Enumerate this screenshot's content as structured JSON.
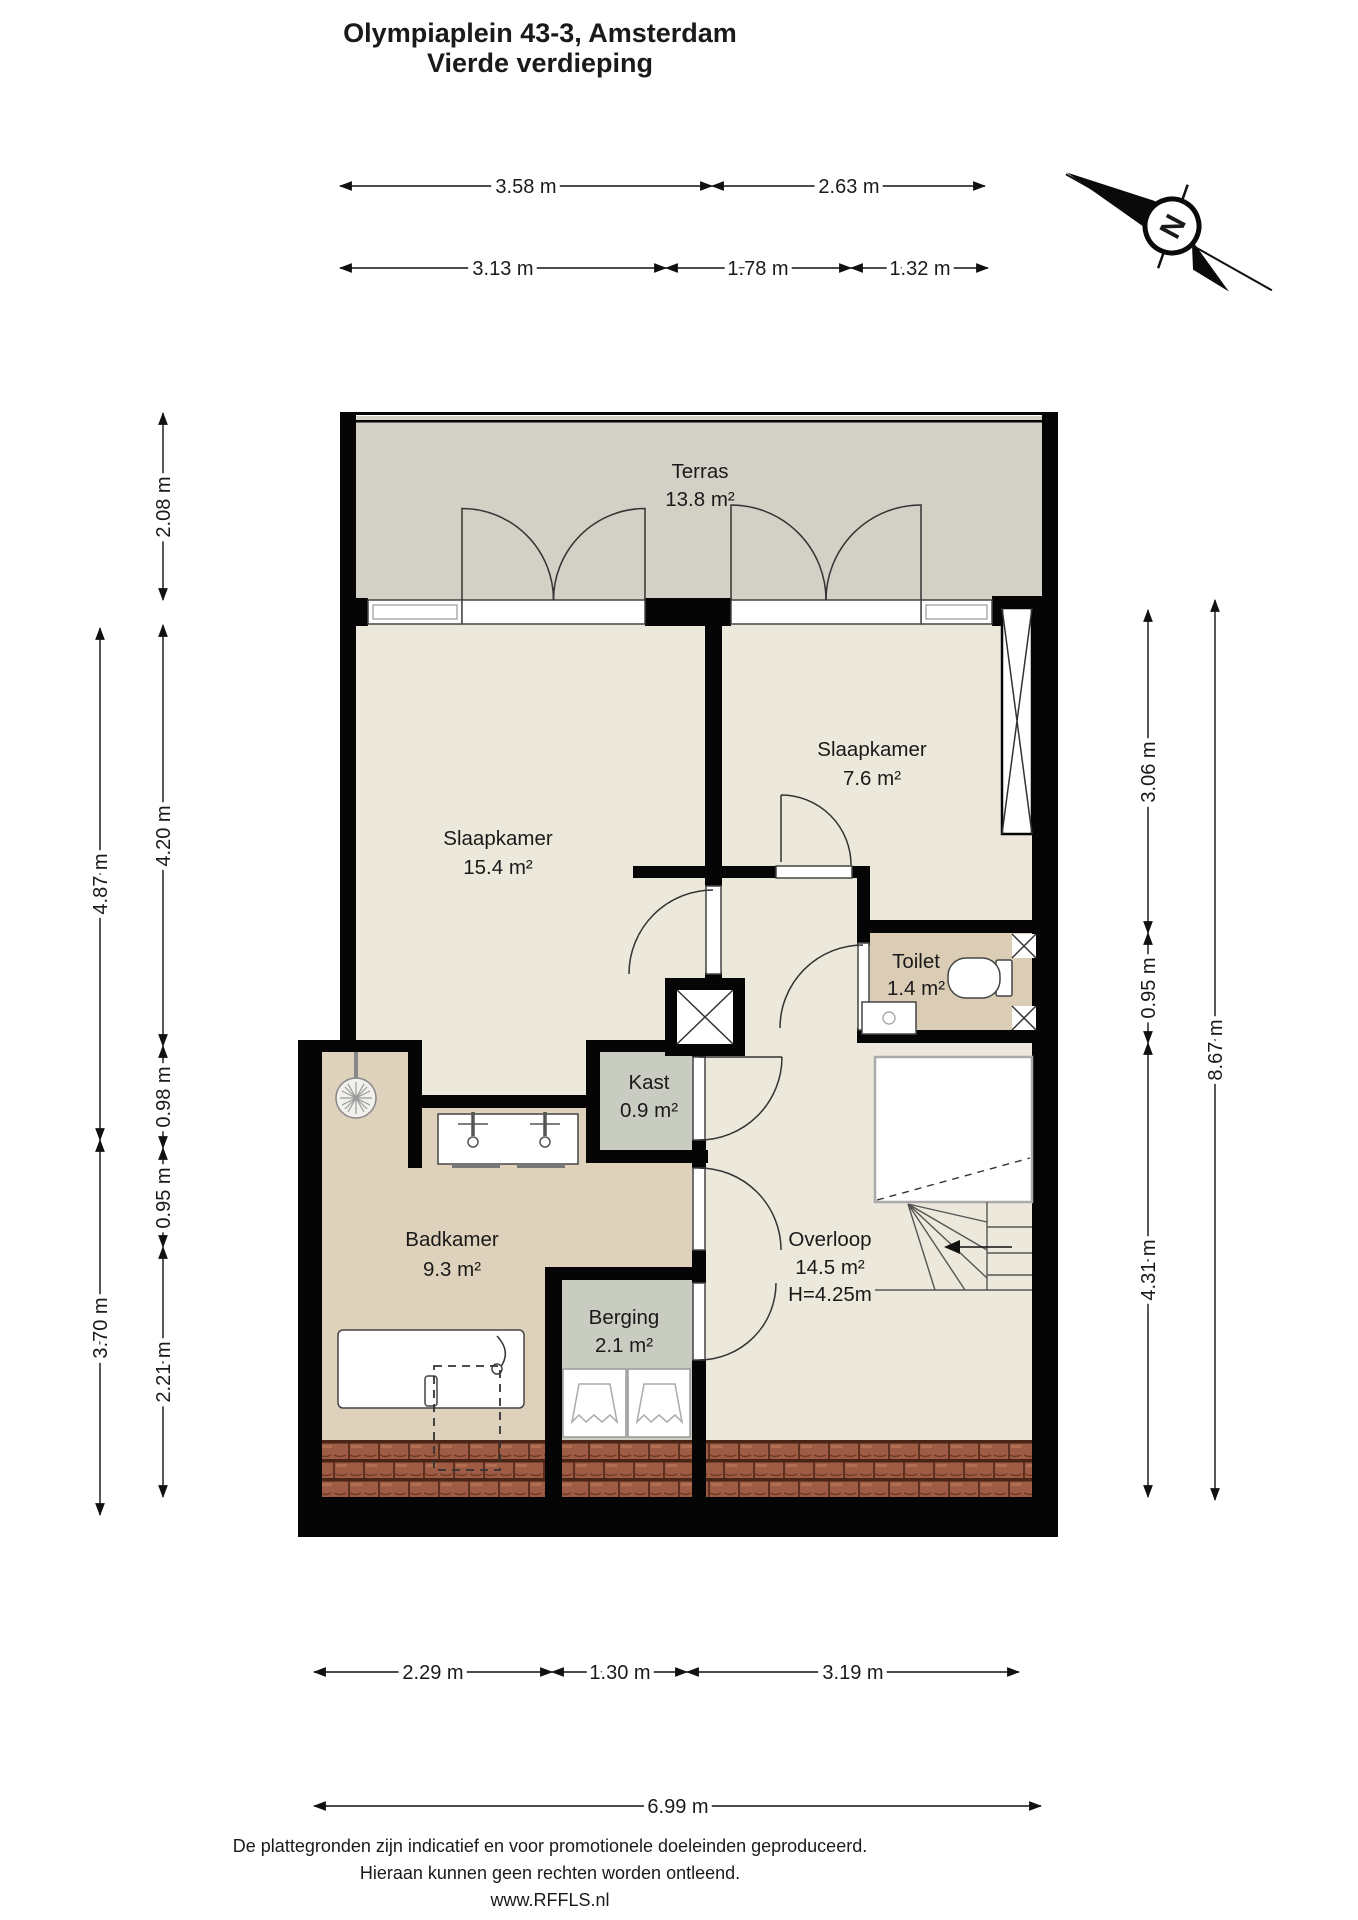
{
  "title": {
    "line1": "Olympiaplein 43-3, Amsterdam",
    "line2": "Vierde verdieping"
  },
  "compass": {
    "north_label": "N"
  },
  "rooms": {
    "terras": {
      "name": "Terras",
      "area": "13.8 m²"
    },
    "slaapkamer1": {
      "name": "Slaapkamer",
      "area": "15.4 m²"
    },
    "slaapkamer2": {
      "name": "Slaapkamer",
      "area": "7.6 m²"
    },
    "toilet": {
      "name": "Toilet",
      "area": "1.4 m²"
    },
    "kast": {
      "name": "Kast",
      "area": "0.9 m²"
    },
    "badkamer": {
      "name": "Badkamer",
      "area": "9.3 m²"
    },
    "berging": {
      "name": "Berging",
      "area": "2.1 m²"
    },
    "overloop": {
      "name": "Overloop",
      "area": "14.5 m²",
      "height": "H=4.25m"
    }
  },
  "dimensions": {
    "top_row1": [
      "3.58 m",
      "2.63 m"
    ],
    "top_row2": [
      "3.13 m",
      "1.78 m",
      "1.32 m"
    ],
    "left_outer": [
      "4.87 m",
      "3.70 m"
    ],
    "left_inner": [
      "2.08 m",
      "4.20 m",
      "0.98 m",
      "0.95 m",
      "2.21 m"
    ],
    "right_inner": [
      "3.06 m",
      "0.95 m",
      "4.31 m"
    ],
    "right_outer": [
      "8.67 m"
    ],
    "bottom_row1": [
      "2.29 m",
      "1.30 m",
      "3.19 m"
    ],
    "bottom_row2": [
      "6.99 m"
    ]
  },
  "footer": {
    "line1": "De plattegronden zijn indicatief en voor promotionele doeleinden geproduceerd.",
    "line2": "Hieraan kunnen geen rechten worden ontleend.",
    "line3": "www.RFFLS.nl"
  },
  "colors": {
    "wall": "#050505",
    "terrace_floor": "#d3d0c5",
    "room_floor": "#ece8db",
    "wet_floor": "#dfd2bc",
    "storage_floor": "#c8ccc1",
    "roof_tiles": "#9f5c44",
    "roof_tile_shadow": "#4a2517"
  }
}
